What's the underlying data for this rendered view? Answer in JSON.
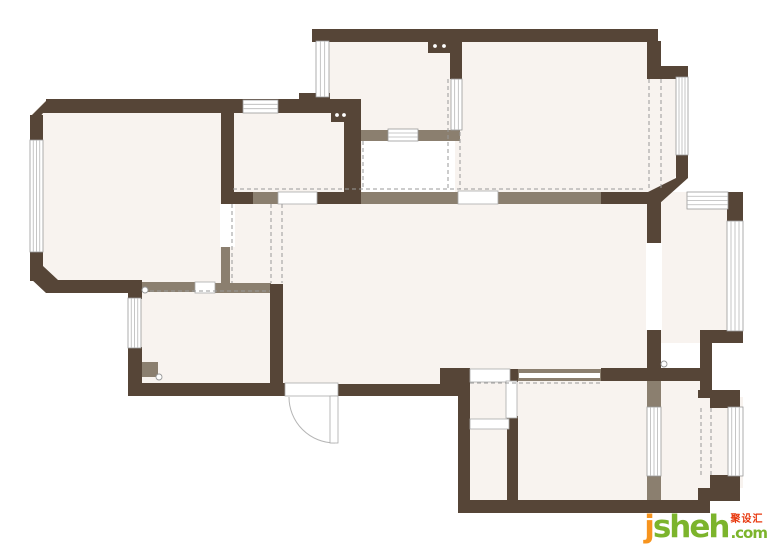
{
  "canvas": {
    "width": 770,
    "height": 544
  },
  "watermark": {
    "brand_j": "j",
    "brand_rest": "sheh",
    "cn_label": "聚设汇",
    "tld": ".com",
    "color_j": "#F7941E",
    "color_brand": "#7CB42C",
    "color_cn": "#E8390F"
  },
  "plan": {
    "colors": {
      "wall": "#564537",
      "partition": "#8B7F6F",
      "floor": "#F8F3EF",
      "window_frame": "#999999",
      "window_line": "#B7B7B7",
      "opening_frame": "#AAAAAA",
      "dash": "#9A9A9A",
      "arc": "#B5B5B5",
      "white": "#FFFFFF"
    },
    "floor_polys": [
      "47,99 233,99 233,292 47,292 30,276 30,116",
      "455,29 658,29 658,67 687,67 687,158 658,204 455,204"
    ],
    "floor_rects": [
      [
        222,
        100,
        140,
        104
      ],
      [
        316,
        29,
        146,
        112
      ],
      [
        648,
        192,
        95,
        151
      ],
      [
        233,
        192,
        427,
        190
      ],
      [
        283,
        192,
        165,
        201
      ],
      [
        128,
        284,
        155,
        110
      ],
      [
        458,
        368,
        245,
        145
      ],
      [
        648,
        380,
        63,
        121
      ],
      [
        700,
        397,
        43,
        91
      ]
    ],
    "partitions": [
      [
        252,
        192,
        26,
        12
      ],
      [
        345,
        192,
        115,
        12
      ],
      [
        497,
        192,
        104,
        12
      ],
      [
        360,
        130,
        100,
        11
      ],
      [
        221,
        247,
        9,
        38
      ],
      [
        142,
        282,
        53,
        10
      ],
      [
        214,
        283,
        57,
        10
      ],
      [
        517,
        369,
        84,
        12
      ],
      [
        647,
        378,
        14,
        30
      ],
      [
        647,
        475,
        14,
        28
      ],
      [
        142,
        362,
        16,
        15
      ],
      [
        272,
        355,
        10,
        29
      ]
    ],
    "walls": [
      [
        46,
        99,
        314,
        14
      ],
      [
        30,
        115,
        13,
        28
      ],
      [
        30,
        251,
        13,
        30
      ],
      [
        46,
        280,
        96,
        13
      ],
      [
        221,
        113,
        13,
        91
      ],
      [
        344,
        99,
        17,
        105
      ],
      [
        299,
        93,
        31,
        20
      ],
      [
        312,
        29,
        346,
        13
      ],
      [
        450,
        29,
        12,
        50
      ],
      [
        647,
        41,
        14,
        38
      ],
      [
        647,
        66,
        41,
        13
      ],
      [
        676,
        154,
        12,
        24
      ],
      [
        601,
        192,
        57,
        12
      ],
      [
        315,
        192,
        30,
        12
      ],
      [
        221,
        192,
        32,
        12
      ],
      [
        727,
        192,
        16,
        30
      ],
      [
        647,
        192,
        14,
        51
      ],
      [
        647,
        330,
        14,
        39
      ],
      [
        700,
        330,
        43,
        13
      ],
      [
        700,
        330,
        12,
        67
      ],
      [
        601,
        368,
        99,
        13
      ],
      [
        698,
        390,
        42,
        8
      ],
      [
        710,
        397,
        30,
        11
      ],
      [
        710,
        475,
        30,
        14
      ],
      [
        698,
        488,
        42,
        13
      ],
      [
        458,
        500,
        252,
        13
      ],
      [
        458,
        368,
        12,
        145
      ],
      [
        440,
        368,
        30,
        28
      ],
      [
        338,
        384,
        120,
        12
      ],
      [
        128,
        383,
        157,
        13
      ],
      [
        270,
        284,
        13,
        112
      ],
      [
        128,
        283,
        14,
        16
      ],
      [
        128,
        347,
        14,
        37
      ],
      [
        507,
        416,
        11,
        87
      ],
      [
        510,
        369,
        8,
        13
      ]
    ],
    "wall_polys": [
      "30,117 47,100 59,100 59,113 43,113 30,130",
      "30,266 30,278 46,293 58,293 58,280 43,266",
      "676,178 688,178 659,204 648,204 648,192"
    ],
    "windows": [
      [
        30,
        140,
        13,
        112,
        "v",
        3
      ],
      [
        243,
        100,
        35,
        13,
        "h",
        2
      ],
      [
        316,
        41,
        13,
        56,
        "v",
        2
      ],
      [
        388,
        129,
        30,
        12,
        "h",
        2
      ],
      [
        676,
        77,
        12,
        78,
        "v",
        3
      ],
      [
        687,
        192,
        41,
        17,
        "h",
        3
      ],
      [
        727,
        221,
        16,
        110,
        "v",
        3
      ],
      [
        128,
        298,
        13,
        50,
        "v",
        3
      ],
      [
        647,
        407,
        14,
        69,
        "v",
        3
      ],
      [
        728,
        407,
        15,
        69,
        "v",
        3
      ],
      [
        451,
        79,
        11,
        51,
        "v",
        2
      ]
    ],
    "openings": [
      [
        278,
        192,
        39,
        12
      ],
      [
        458,
        191,
        40,
        13
      ],
      [
        470,
        369,
        40,
        13
      ],
      [
        506,
        381,
        11,
        37
      ],
      [
        470,
        419,
        39,
        10
      ],
      [
        285,
        383,
        53,
        13
      ],
      [
        195,
        282,
        20,
        11
      ]
    ],
    "gaps": [
      [
        646,
        243,
        16,
        87
      ],
      [
        220,
        204,
        15,
        43
      ],
      [
        519,
        373,
        81,
        5
      ]
    ],
    "door": {
      "arc": "M 289 397 A 46 46 0 0 0 335 443",
      "leaf": [
        330,
        396,
        8,
        47
      ]
    },
    "dashes": [
      [
        233,
        189,
        645,
        189
      ],
      [
        232,
        204,
        232,
        283
      ],
      [
        271,
        204,
        271,
        283
      ],
      [
        282,
        204,
        282,
        283
      ],
      [
        448,
        79,
        448,
        189
      ],
      [
        460,
        132,
        460,
        189
      ],
      [
        363,
        141,
        363,
        189
      ],
      [
        649,
        79,
        649,
        190
      ],
      [
        661,
        79,
        661,
        190
      ],
      [
        150,
        291,
        270,
        291
      ],
      [
        701,
        408,
        701,
        475
      ],
      [
        711,
        408,
        711,
        475
      ],
      [
        470,
        383,
        600,
        383
      ]
    ],
    "sockets": [
      {
        "rect": [
          428,
          39,
          24,
          14
        ],
        "dots": [
          [
            435,
            46
          ],
          [
            444,
            46
          ]
        ]
      },
      {
        "rect": [
          331,
          108,
          19,
          14
        ],
        "dots": [
          [
            337,
            115
          ],
          [
            344,
            115
          ]
        ]
      }
    ],
    "pins": [
      [
        145,
        290,
        3
      ],
      [
        159,
        377,
        3
      ],
      [
        664,
        364,
        3
      ]
    ]
  }
}
